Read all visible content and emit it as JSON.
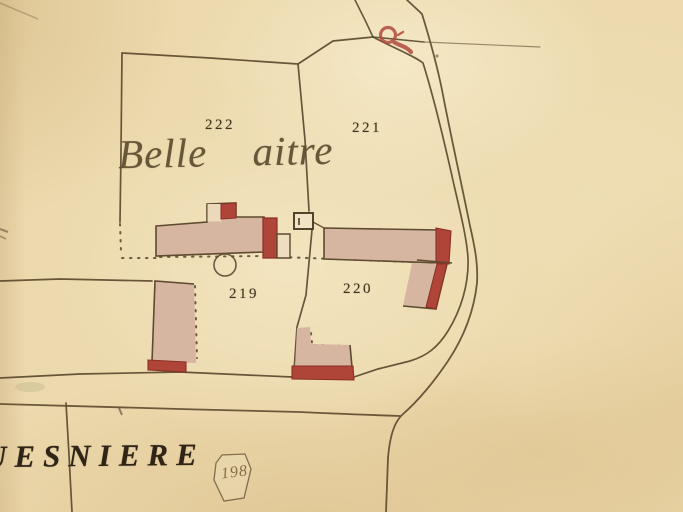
{
  "map": {
    "type": "cadastral-plan-scan",
    "labels": {
      "parcel_222": "222",
      "parcel_221": "221",
      "parcel_219": "219",
      "parcel_220": "220",
      "place_name": "Belle aitre",
      "hamlet_name": "UESNIERE",
      "sheet_number": "198"
    },
    "symbols": {
      "cross_marker": "red roadside cross/marker at road junction",
      "well": "small circle (well) attached to south side of main building",
      "outbuilding": "small square structure between buildings"
    },
    "colors": {
      "paper": "#ecd9ad",
      "ink": "#5d4a2f",
      "building_fill": "#d6b6a1",
      "building_accent_red": "#ae4538",
      "label_ink": "#43351f"
    }
  }
}
